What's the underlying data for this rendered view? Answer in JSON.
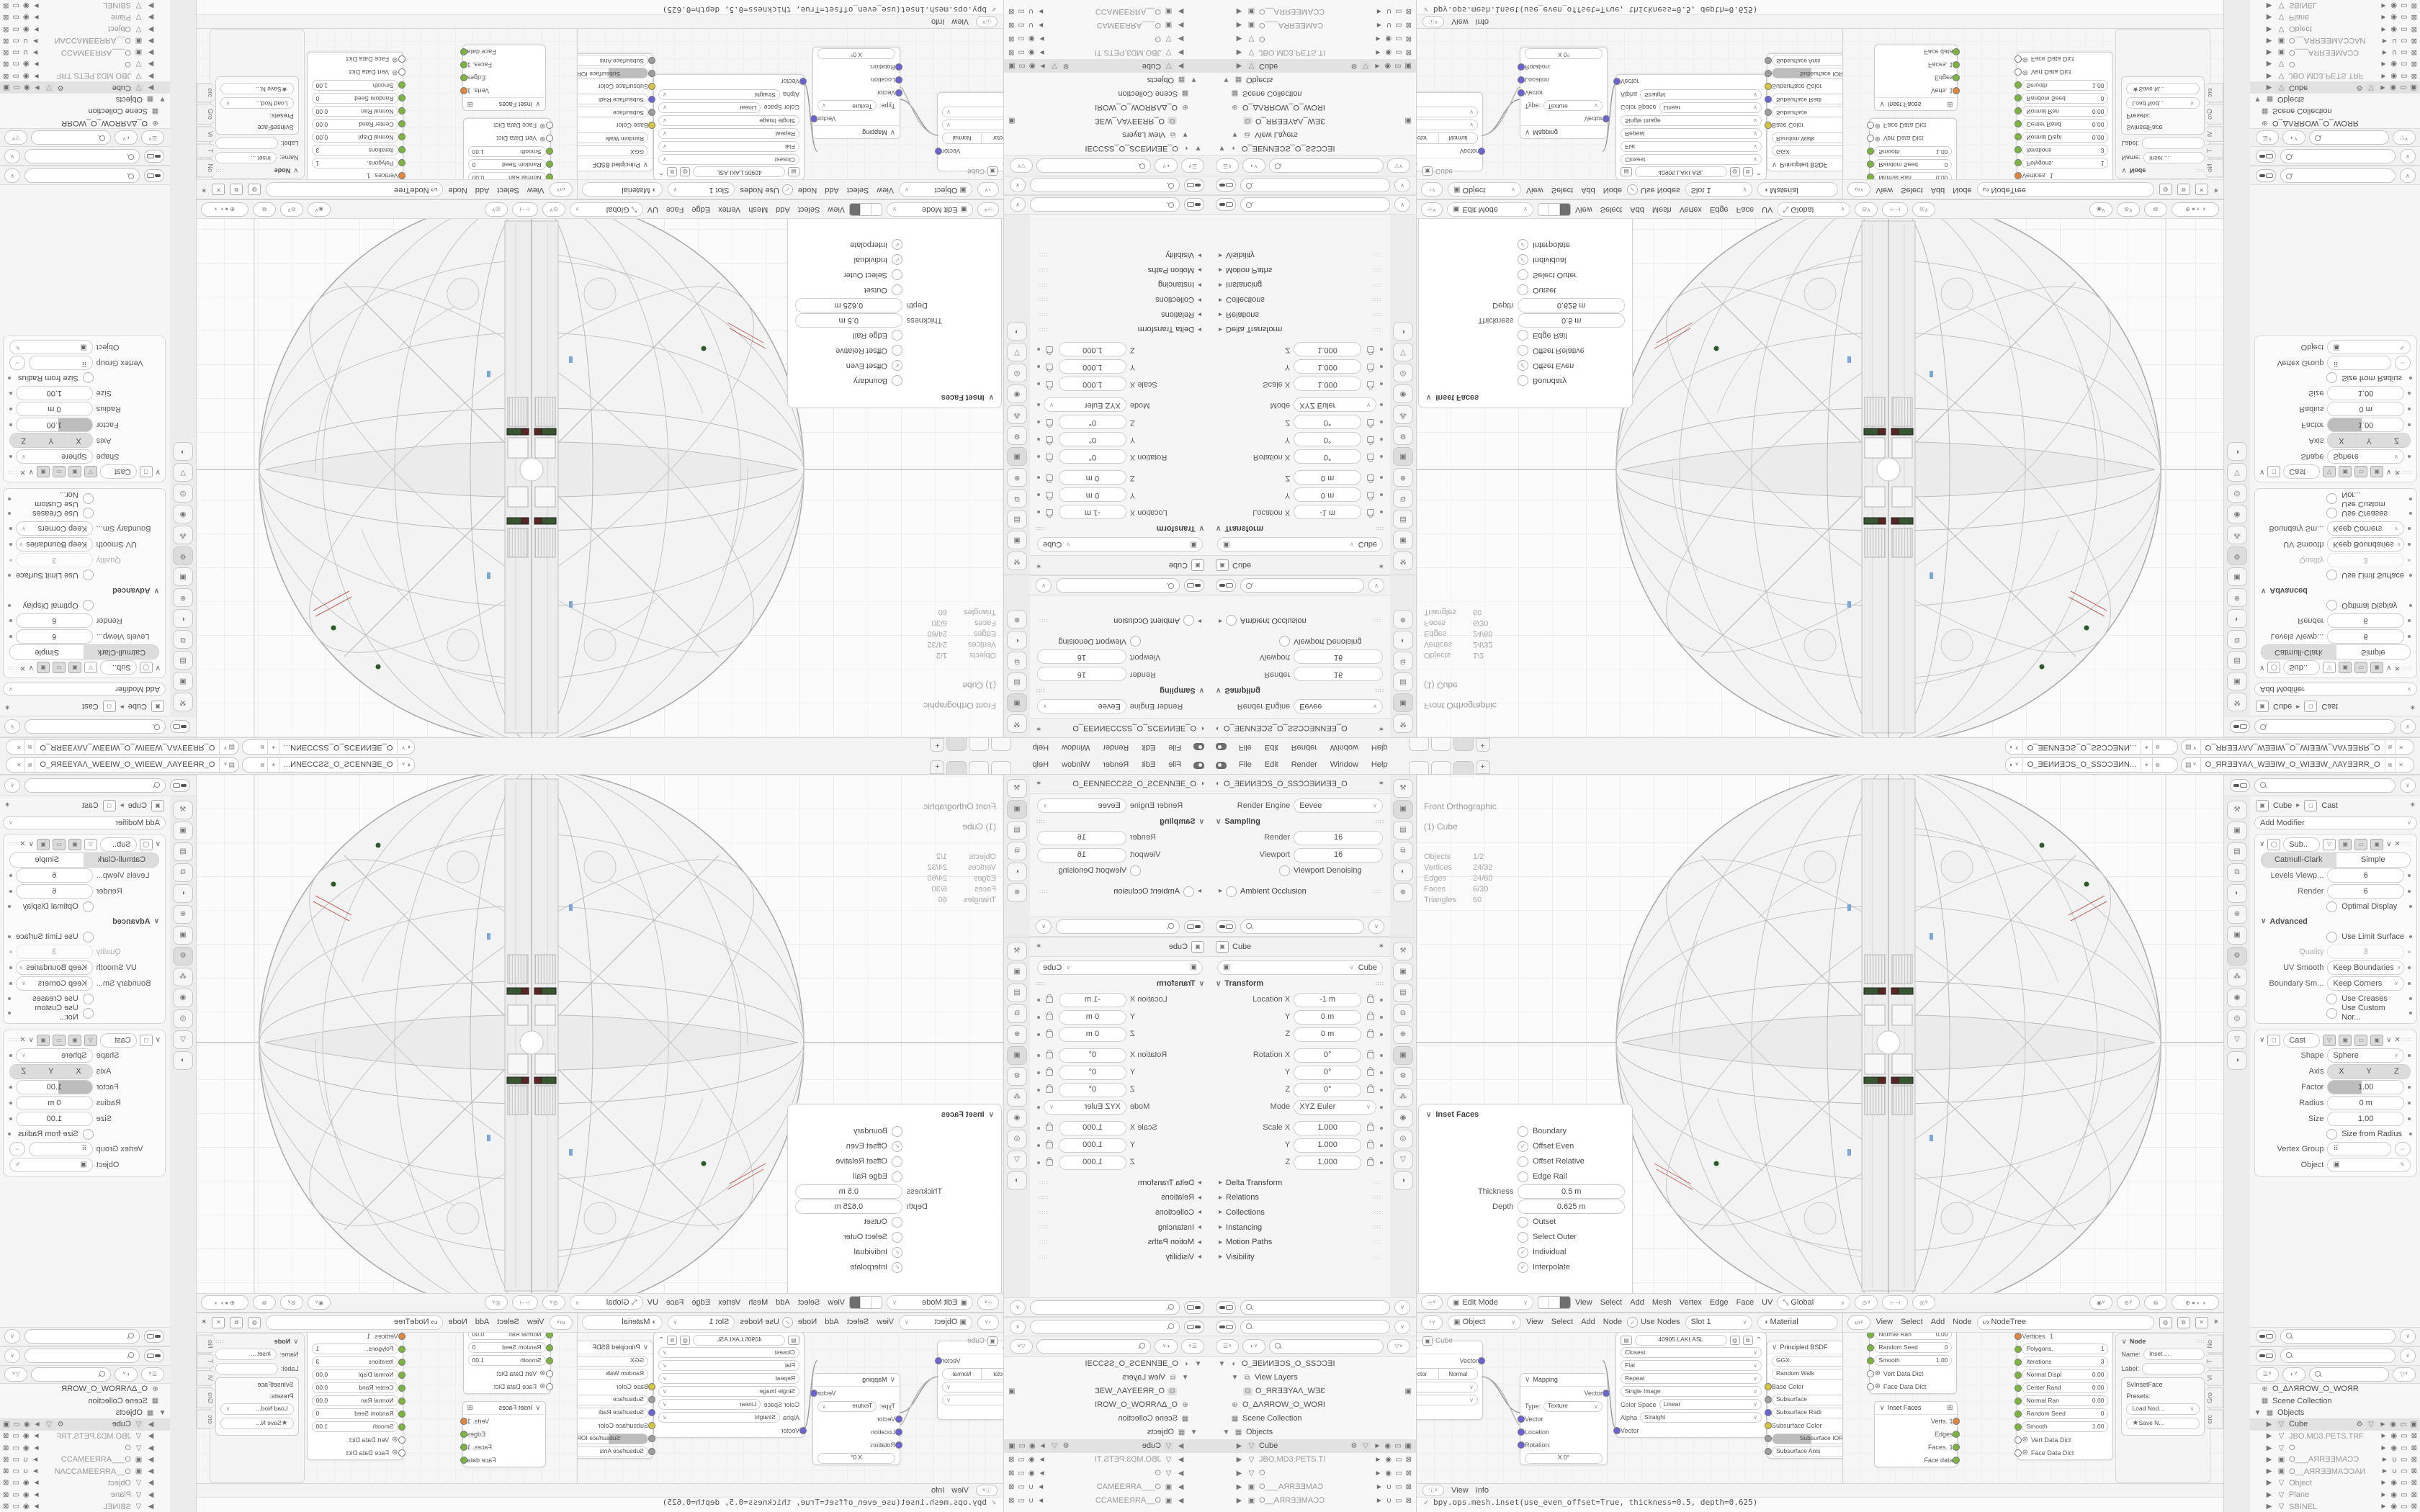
{
  "colors": {
    "ui_bg": "#ececec",
    "panel_bg": "#ffffff",
    "text": "#4d4d4d",
    "muted": "#9a9a9a",
    "selection_row": "#e2e2e2",
    "socket_green": "#7cb53e",
    "socket_orange": "#e0873d",
    "socket_blue": "#6a63d4",
    "socket_yellow": "#d6c63f",
    "socket_gray": "#9e9e9e",
    "detail_green": "#35562f",
    "detail_red": "#5a2424",
    "detail_blue": "#7aa7d8"
  },
  "icons": {
    "chevron_down": "∨",
    "chevron_right": "▸",
    "caret_down": "▼",
    "caret_right": "▶",
    "close": "✕",
    "check": "✓",
    "dot": "•",
    "grip": "∷∷",
    "menu": "☰",
    "eye": "◉",
    "eye_closed": "∪",
    "monitor": "▭",
    "camera": "▣",
    "cursor": "►",
    "world": "⊕",
    "mesh": "▽",
    "wrench": "⚙",
    "link": "⇔",
    "dropper": "✎",
    "pin": "✶",
    "star": "★",
    "plus": "+",
    "info": "ⓘ",
    "funnel": "▽",
    "grid": "⊞",
    "image": "▤",
    "scene": "◐",
    "object": "▣",
    "tool": "⚒"
  },
  "topbar": {
    "menus": [
      "File",
      "Edit",
      "Render",
      "Window",
      "Help"
    ],
    "workspace_tabs": [
      "",
      "",
      ""
    ],
    "new_tab": "+",
    "scene_name": "O_ƎEИИƎƆS_O_SSƆƆƎИN...",
    "view_layer_name": "O_ЯRƎƎYAΛ_WƎƎIW_O_WIƎƎW_ΛAYƎƎRR_O"
  },
  "render_props": {
    "breadcrumb": "O_ƎEИИƎƆS_O_SSƆƆƎИИƎƎ_O",
    "engine_label": "Render Engine",
    "engine_value": "Eevee",
    "sampling_label": "Sampling",
    "render_label": "Render",
    "render_value": "16",
    "viewport_label": "Viewport",
    "viewport_value": "16",
    "denoising_label": "Viewport Denoising",
    "ao_label": "Ambient Occlusion"
  },
  "object_props": {
    "title": "Cube",
    "name_value": "Cube",
    "transform_label": "Transform",
    "loc_rows": [
      {
        "label": "Location X",
        "value": "-1 m"
      },
      {
        "label": "Y",
        "value": "0 m"
      },
      {
        "label": "Z",
        "value": "0 m"
      }
    ],
    "rot_rows": [
      {
        "label": "Rotation X",
        "value": "0°"
      },
      {
        "label": "Y",
        "value": "0°"
      },
      {
        "label": "Z",
        "value": "0°"
      }
    ],
    "mode_label": "Mode",
    "mode_value": "XYZ Euler",
    "scale_rows": [
      {
        "label": "Scale X",
        "value": "1.000"
      },
      {
        "label": "Y",
        "value": "1.000"
      },
      {
        "label": "Z",
        "value": "1.000"
      }
    ],
    "sections": [
      "Delta Transform",
      "Relations",
      "Collections",
      "Instancing",
      "Motion Paths",
      "Visibility"
    ]
  },
  "outliner_left": {
    "rows": [
      {
        "label": "O_ƎEИИƎƆS_O_SSƆƆƎI",
        "type": "scene",
        "caret": "▼",
        "indent": 0
      },
      {
        "label": "View Layers",
        "type": "viewlayers",
        "caret": "▼",
        "indent": 1
      },
      {
        "label": "O_ЯRƎƎYAΛ_WƎƐ",
        "type": "viewlayer",
        "indent": 2,
        "right_camera": true
      },
      {
        "label": "O_ΔΛЯROW_O_WOЯI",
        "type": "world",
        "indent": 1
      },
      {
        "label": "Scene Collection",
        "type": "collection",
        "indent": 1
      },
      {
        "label": "Objects",
        "type": "collection",
        "caret": "▼",
        "indent": 1
      },
      {
        "label": "Cube",
        "type": "mesh",
        "indent": 2,
        "selected": true
      },
      {
        "label": "JBO.MD3.PETS.TI",
        "type": "mesh",
        "indent": 2,
        "muted": true
      },
      {
        "label": "O",
        "type": "mesh",
        "indent": 2,
        "muted": true
      },
      {
        "label": "O___AЯRƎƎMAƆ",
        "type": "camera",
        "indent": 2,
        "muted": true
      },
      {
        "label": "O__AЯRƎƎMAƆƆ",
        "type": "camera",
        "indent": 2,
        "muted": true
      }
    ]
  },
  "outliner_right": {
    "rows": [
      {
        "label": "O_ΔΛЯROW_O_WOЯR",
        "type": "world",
        "indent": 0
      },
      {
        "label": "Scene Collection",
        "type": "collection",
        "indent": 0
      },
      {
        "label": "Objects",
        "type": "collection",
        "caret": "▼",
        "indent": 0
      },
      {
        "label": "Cube",
        "type": "mesh",
        "indent": 1,
        "selected": true
      },
      {
        "label": "JBO.MD3.PETS.TRF",
        "type": "mesh",
        "indent": 1,
        "muted": true
      },
      {
        "label": "O",
        "type": "mesh",
        "indent": 1,
        "muted": true
      },
      {
        "label": "O___AЯRƎƎMAƆƆ",
        "type": "camera",
        "indent": 1,
        "muted": true
      },
      {
        "label": "O__AЯRƎƎMAƆƆAИ",
        "type": "camera",
        "indent": 1,
        "muted": true
      },
      {
        "label": "Object",
        "type": "mesh",
        "indent": 1,
        "muted": true
      },
      {
        "label": "Plane",
        "type": "mesh",
        "indent": 1,
        "muted": true
      },
      {
        "label": "SBINEL",
        "type": "mesh",
        "indent": 1,
        "muted": true
      }
    ]
  },
  "viewport": {
    "overlay_line1": "Front Orthographic",
    "overlay_line2": "(1) Cube",
    "stats": [
      [
        "Objects",
        "1/2"
      ],
      [
        "Vertices",
        "24/32"
      ],
      [
        "Edges",
        "24/60"
      ],
      [
        "Faces",
        "6/30"
      ],
      [
        "Triangles",
        "60"
      ]
    ],
    "mode": "Edit Mode",
    "menus": [
      "View",
      "Select",
      "Add",
      "Mesh",
      "Vertex",
      "Edge",
      "Face",
      "UV"
    ],
    "orientation": "Global"
  },
  "inset_panel": {
    "title": "Inset Faces",
    "checks_top": [
      {
        "label": "Boundary",
        "on": false
      },
      {
        "label": "Offset Even",
        "on": true
      },
      {
        "label": "Offset Relative",
        "on": false
      },
      {
        "label": "Edge Rail",
        "on": false
      }
    ],
    "fields": [
      {
        "label": "Thickness",
        "value": "0.5 m"
      },
      {
        "label": "Depth",
        "value": "0.625 m"
      }
    ],
    "checks_bottom": [
      {
        "label": "Outset",
        "on": false
      },
      {
        "label": "Select Outer",
        "on": false
      },
      {
        "label": "Individual",
        "on": true
      },
      {
        "label": "Interpolate",
        "on": true
      }
    ]
  },
  "shader_editor": {
    "context": "Object",
    "menus": [
      "View",
      "Select",
      "Add",
      "Node"
    ],
    "use_nodes": "Use Nodes",
    "slot": "Slot 1",
    "material": "Material",
    "crumb": "Cube",
    "vector_transform": {
      "title": "Vector Transform",
      "tabs": [
        "Point",
        "Vector",
        "Normal"
      ],
      "rows": [
        "Object",
        "World"
      ],
      "out": "Vector"
    },
    "mapping": {
      "title": "Mapping",
      "out": "Vector",
      "type_label": "Type:",
      "type_value": "Texture",
      "inputs": [
        "Vector",
        "Location",
        "Rotation:"
      ],
      "sub_field": "X        0°"
    },
    "image_texture": {
      "name": "40905.LAKI.ASL",
      "selects": [
        "Closest",
        "Flat",
        "Repeat",
        "Single Image"
      ],
      "rows": [
        {
          "label": "Color Space",
          "value": "Linear"
        },
        {
          "label": "Alpha",
          "value": "Straight"
        }
      ],
      "input": "Vector"
    },
    "principled": {
      "title": "Principled BSDF",
      "selects": [
        "GGX",
        "Random Walk"
      ],
      "sockets": [
        {
          "label": "Base Color",
          "c": "yellow"
        },
        {
          "label": "Subsurface",
          "c": "gray"
        },
        {
          "label": "Subsurface Radi",
          "c": "blue"
        },
        {
          "label": "Subsurface Color",
          "c": "yellow"
        },
        {
          "label": "Subsurface IOR",
          "c": "gray"
        },
        {
          "label": "Subsurface Anis",
          "c": "gray"
        }
      ]
    }
  },
  "sverchok_editor": {
    "menus": [
      "View",
      "Select",
      "Add",
      "Node"
    ],
    "tree_name": "NodeTree",
    "node_a": {
      "rows": [
        [
          "Normal Ran",
          "0.00"
        ],
        [
          "Random Seed",
          "0"
        ],
        [
          "Smooth",
          "1.00"
        ]
      ],
      "dicts": [
        "Vert Data Dict",
        "Face Data Dict"
      ]
    },
    "inset_node": {
      "title": "Inset Faces",
      "outputs": [
        {
          "label": "Verts. 1",
          "c": "orange"
        },
        {
          "label": "Edges",
          "c": "green"
        },
        {
          "label": "Faces. 1",
          "c": "green"
        },
        {
          "label": "Face data",
          "c": "green"
        }
      ]
    },
    "node_b": {
      "rows": [
        [
          "Vertices.",
          "1"
        ],
        [
          "Polygons.",
          "1"
        ],
        [
          "Iterations",
          "3"
        ],
        [
          "Normal Displ",
          "0.00"
        ],
        [
          "Center Rand",
          "0.00"
        ],
        [
          "Normal Ran",
          "0.00"
        ],
        [
          "Random Seed",
          "0"
        ],
        [
          "Smooth",
          "1.00"
        ]
      ],
      "dicts": [
        "Vert Data Dict",
        "Face Data Dict"
      ]
    },
    "npanel": {
      "section": "Node",
      "name_label": "Name:",
      "name_value": "Inset ...",
      "label_label": "Label:",
      "box": "SvInsetFace",
      "presets": "Presets:",
      "load": "Load Nod...",
      "save": "Save N...",
      "tabs": [
        "No",
        "T",
        "Vi",
        "Gro",
        "erc"
      ]
    }
  },
  "modifier_props": {
    "crumb_object": "Cube",
    "crumb_modifier": "Cast",
    "add_modifier": "Add Modifier",
    "subdivision": {
      "name": "Sub..",
      "types": [
        "Catmull-Clark",
        "Simple"
      ],
      "rows": [
        {
          "label": "Levels Viewp...",
          "value": "6"
        },
        {
          "label": "Render",
          "value": "6"
        }
      ],
      "optimal": "Optimal Display",
      "advanced": "Advanced",
      "limit": "Use Limit Surface",
      "quality_label": "Quality",
      "quality_value": "3",
      "uv_label": "UV Smooth",
      "uv_value": "Keep Boundaries",
      "bound_label": "Boundary Sm...",
      "bound_value": "Keep Corners",
      "creases": "Use Creases",
      "normals": "Use Custom Nor..."
    },
    "cast": {
      "name": "Cast",
      "shape_label": "Shape",
      "shape_value": "Sphere",
      "axis_label": "Axis",
      "axis": [
        "X",
        "Y",
        "Z"
      ],
      "factor_label": "Factor",
      "factor_value": "1.00",
      "radius_label": "Radius",
      "radius_value": "0 m",
      "size_label": "Size",
      "size_value": "1.00",
      "size_from": "Size from Radius",
      "vg_label": "Vertex Group",
      "object_label": "Object"
    }
  },
  "info_editor": {
    "menus": [
      "View",
      "Info"
    ],
    "log": "bpy.ops.mesh.inset(use_even_offset=True, thickness=0.5, depth=0.625)"
  }
}
